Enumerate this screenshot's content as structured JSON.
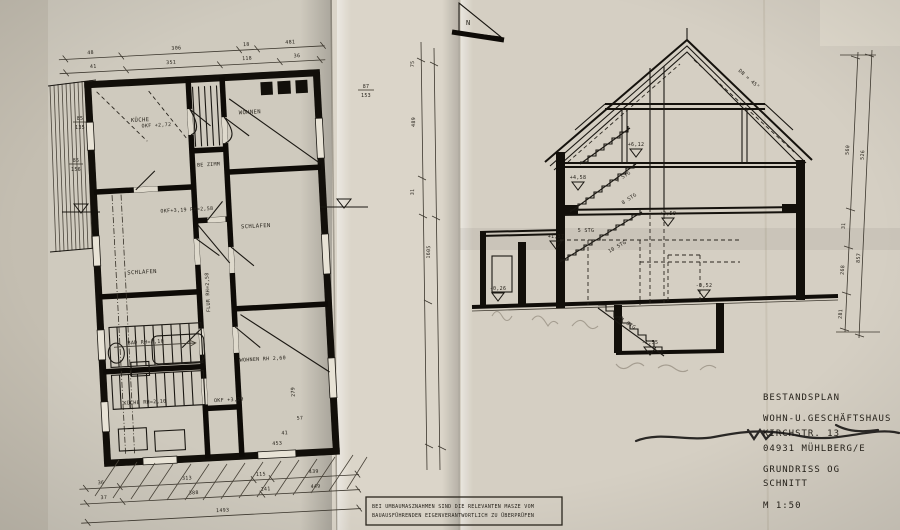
{
  "colors": {
    "paper": "#d6d0c5",
    "paper_bright": "#e4decf",
    "ink": "#17140f"
  },
  "north": {
    "label": "N"
  },
  "title_block": {
    "l1": "BESTANDSPLAN",
    "l2": "WOHN-U.GESCHÄFTSHAUS",
    "l3": "KIRCHSTR. 13",
    "l4": "04931 MÜHLBERG/E",
    "l5": "GRUNDRISS OG",
    "l6": "SCHNITT",
    "l7": "M 1:50"
  },
  "note": {
    "line1": "BEI UMBAUMASZNAHMEN SIND DIE RELEVANTEN MASZE VOM",
    "line2": "BAUAUSFÜHRENDEN EIGENVERANTWORTLICH ZU ÜBERPRÜFEN"
  },
  "plan": {
    "rooms": {
      "kueche_top": "KÜCHE",
      "wohnen_top": "WOHNEN",
      "kammer": "BE ZIMM",
      "schlafen_right": "SCHLAFEN",
      "schlafen_left": "SCHLAFEN",
      "bad": "BAD RH=2,10",
      "kueche_bottom": "KÜCHE RH=2,10",
      "wohnen_bottom": "WOHNEN RH 2,60",
      "flur": "FLUR RH=2,58"
    },
    "annotations": {
      "a1": "OKF +2,72",
      "a2": "OKF+3,19 RH=2,58",
      "a3": "OKF +3,29"
    },
    "dims": {
      "top1": [
        "48",
        "306",
        "18",
        "481"
      ],
      "top2": [
        "41",
        "351",
        "118",
        "36"
      ],
      "bottom1": [
        "36",
        "313",
        "115",
        "439"
      ],
      "bottom2": [
        "37",
        "388",
        "141",
        "449"
      ],
      "total": "1493",
      "right": [
        "453",
        "279",
        "57",
        "41"
      ],
      "fr1_top": "85",
      "fr1_bot": "135",
      "fr2_top": "85",
      "fr2_bot": "156"
    }
  },
  "mid": {
    "fraction_top": "87",
    "fraction_bottom": "153",
    "values": [
      "75",
      "489",
      "31",
      "1605"
    ]
  },
  "section": {
    "levels": [
      "+6,12",
      "+4,58",
      "+3,59",
      "+1,37",
      "-0,26",
      "-0,52",
      "-1,55"
    ],
    "stairs": [
      "9 STG",
      "8 STG",
      "10 STG",
      "11 STG",
      "5 STG"
    ],
    "roof_pitch": "DN = 45°"
  },
  "right_dims": [
    "560",
    "31",
    "268",
    "281",
    "526",
    "857"
  ]
}
